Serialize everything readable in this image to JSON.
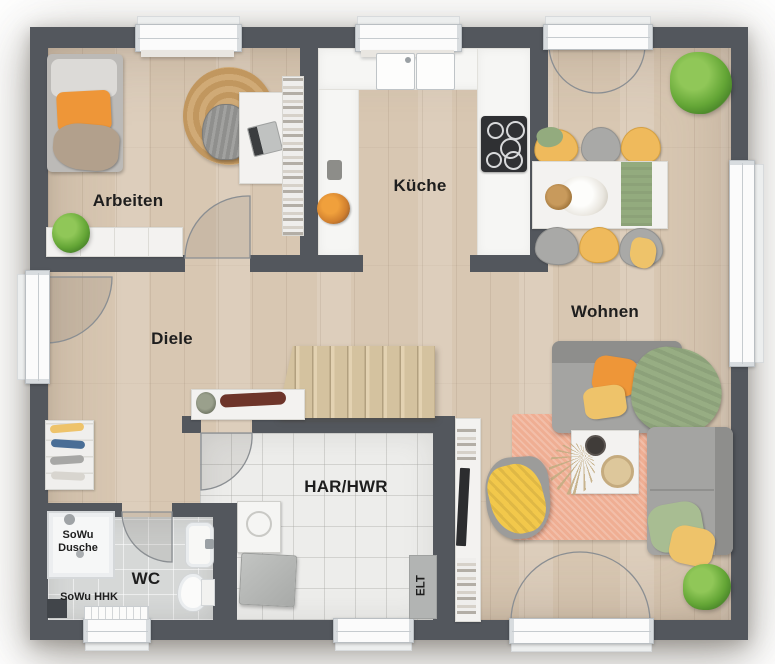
{
  "rooms": {
    "arbeiten": {
      "label": "Arbeiten"
    },
    "kueche": {
      "label": "Küche"
    },
    "wohnen": {
      "label": "Wohnen"
    },
    "diele": {
      "label": "Diele"
    },
    "har_hwr": {
      "label": "HAR/HWR"
    },
    "wc": {
      "label": "WC"
    }
  },
  "annotations": {
    "sowu_dusche_line1": "SoWu",
    "sowu_dusche_line2": "Dusche",
    "sowu_hhk": "SoWu HHK",
    "elt": "ELT"
  },
  "colors": {
    "wall": "#53575d",
    "wood": "#d8c7b2",
    "tile-har": "#ededeb",
    "tile-wc": "#d6d8d7",
    "counter": "#f6f6f4",
    "window": "#fbfbfb",
    "rug-peach": "#efae93",
    "rug-jute": "#c9a26b",
    "accent-orange": "#ee9638",
    "accent-yellow": "#eec36a",
    "accent-green": "#93ab7e",
    "sofa-gray": "#a4a4a2",
    "label": "#1e1e1e"
  }
}
